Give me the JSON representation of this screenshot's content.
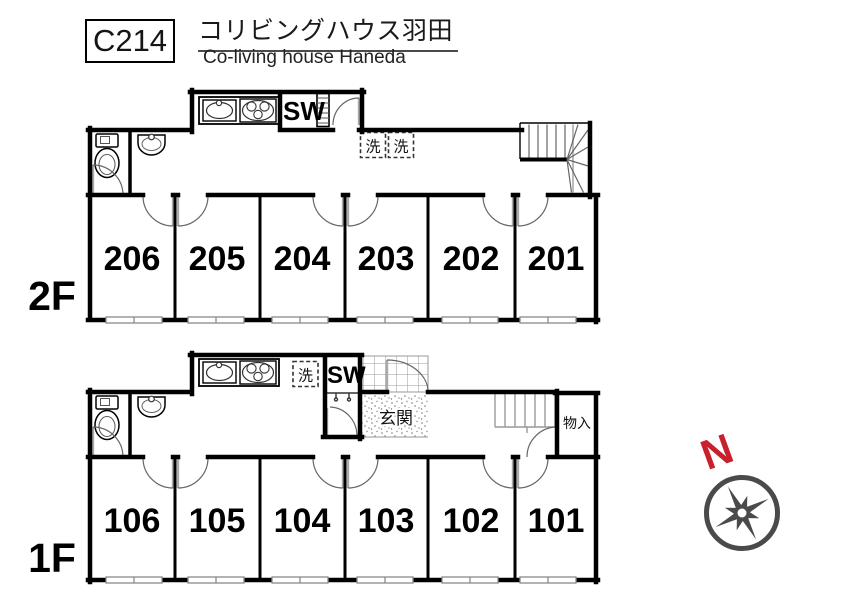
{
  "header": {
    "code": "C214",
    "title_jp": "コリビングハウス羽田",
    "title_en": "Co-living house Haneda"
  },
  "floors": [
    {
      "label": "2F",
      "rooms": [
        "206",
        "205",
        "204",
        "203",
        "202",
        "201"
      ]
    },
    {
      "label": "1F",
      "rooms": [
        "106",
        "105",
        "104",
        "103",
        "102",
        "101"
      ]
    }
  ],
  "plan_labels": {
    "shower_room": "SW",
    "washer": "洗",
    "entrance": "玄関",
    "storage": "物入",
    "north": "N"
  },
  "icons": {
    "toilet": "toilet-icon",
    "hand_basin": "hand-basin-icon",
    "kitchen_sink": "kitchen-sink-icon",
    "stove": "stove-icon",
    "stairs": "stairs-icon",
    "washing_machine": "washing-machine-box-icon",
    "door": "door-swing-icon",
    "compass": "compass-rose-icon"
  },
  "colors": {
    "wall": "#000000",
    "door_arc": "#666666",
    "window_gray": "#8a8a8a",
    "north_red": "#c8202c",
    "compass_gray": "#4a4a4a"
  }
}
